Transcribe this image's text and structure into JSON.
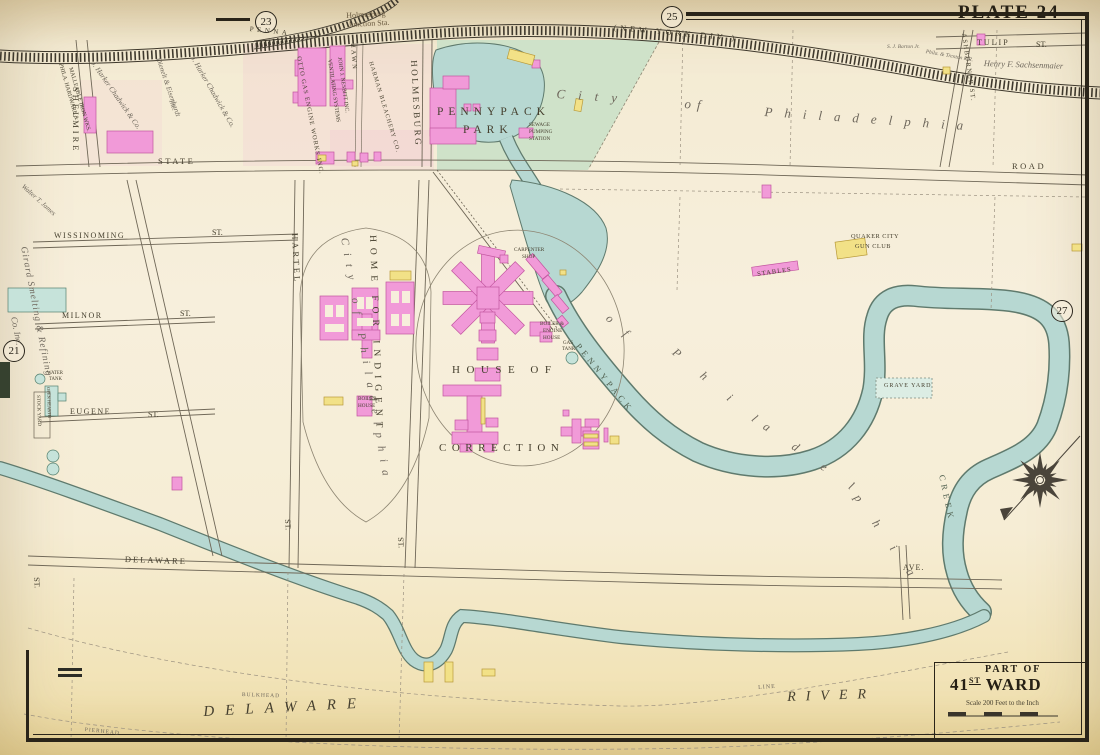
{
  "labels": {
    "plate_title": "PLATE 24",
    "plate_23": "23",
    "plate_25": "25",
    "plate_27": "27",
    "plate_21": "21",
    "station_1": "Holmesburg",
    "station_2": "Junction Sta.",
    "rr_penna": "PENNA",
    "rr_nydiv": "(NEW YORK DIV.)",
    "rr_phila_trenton": "Phila. & Trenton R.R.",
    "barton": "S. J. Barton Jr.",
    "tulip": "TULIP",
    "tulip_st": "ST.",
    "sachsenmaier": "Henry F. Sachsenmaier",
    "ashburner": "ASHBURNER ST.",
    "shelmire": "SHELMIRE",
    "phila_hardware_1": "PHILA. HARDWARE &",
    "phila_hardware_2": "MALLEABLE IRON WKS.",
    "chadwick_1": "J. Harker Chadwick & Co.",
    "chadwick_2": "J. Harker Chadwick & Co.",
    "dienelt_1": "Dienelt & Eisenhardt",
    "dienelt_2": "Inc.",
    "otto": "OTTO GAS ENGINE WORKS INC.",
    "nesbitt_1": "JOHN J. NESBITT INC.",
    "nesbitt_2": "VENTILATING SYSTEMS",
    "hawn": "HAWN",
    "harman": "HARMAN BLEACHERY CO.",
    "holmesburg": "HOLMESBURG",
    "pennypack_1": "PENNYPACK",
    "pennypack_2": "PARK",
    "sewage_1": "SEWAGE",
    "sewage_2": "PUMPING",
    "sewage_3": "STATION",
    "city_1": "City",
    "city_2": "of",
    "city_3": "Philadelphia",
    "state": "STATE",
    "road": "ROAD",
    "walter_james": "Walter T. James",
    "wissinoming": "WISSINOMING",
    "wissinoming_st": "ST.",
    "hartel": "HARTEL",
    "city_vert": "City of Philadelphia",
    "home_indigent": "HOME FOR INDIGENT",
    "milnor": "MILNOR",
    "milnor_st": "ST.",
    "girard_1": "Girard Smelting & Refining",
    "girard_2": "Co. Inc.",
    "water_tank_1": "WATER",
    "water_tank_2": "TANK",
    "stock_yard": "STOCK YARD",
    "open_hearth": "OPEN HEARTH",
    "eugene": "EUGENE",
    "eugene_st": "ST.",
    "house_of": "HOUSE OF",
    "correction": "CORRECTION",
    "carpenter_1": "CARPENTER",
    "carpenter_2": "SHOP",
    "boiler_engine_1": "BOILER &",
    "boiler_engine_2": "ENGINE",
    "boiler_engine_3": "HOUSE",
    "gas_tank_1": "GAS",
    "gas_tank_2": "TANK",
    "boiler_house_1": "BOILER",
    "boiler_house_2": "HOUSE",
    "creek_pennypack": "PENNYPACK",
    "creek_creek": "CREEK",
    "creek_of": "o f",
    "creek_phil": "P h i l",
    "creek_adel": "a d e l",
    "creek_phia": "p h i a",
    "quaker_1": "QUAKER CITY",
    "quaker_2": "GUN CLUB",
    "stables": "STABLES",
    "grave_yard": "GRAVE YARD",
    "delaware_ave": "DELAWARE",
    "ave": "AVE.",
    "st_bottom_left": "ST.",
    "st_hartel": "ST.",
    "st_holmesburg": "ST.",
    "bulkhead": "BULKHEAD",
    "pierhead": "PIERHEAD",
    "line": "LINE",
    "river_delaware": "DELAWARE",
    "river_river": "RIVER",
    "part_of": "PART OF",
    "ward_num": "41",
    "ward_sup": "ST",
    "ward_name": "WARD",
    "scale": "Scale 200 Feet to the Inch"
  },
  "colors": {
    "water": "#b7d8d2",
    "park": "#cfe2c9",
    "building_brick": "#f19ad8",
    "building_frame": "#f2e187",
    "building_stone": "#c6e3da",
    "paper": "#f7efdc",
    "ink": "#46402f"
  }
}
